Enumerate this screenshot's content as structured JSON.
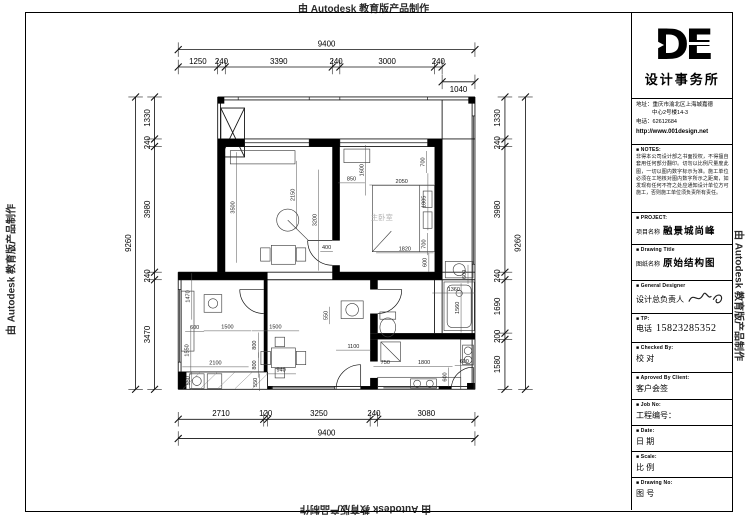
{
  "watermark": {
    "text": "由 Autodesk 教育版产品制作"
  },
  "title_block": {
    "logo_text": "DE",
    "company_name": "设计事务所",
    "address_label": "地址：",
    "address_line1": "重庆市渝北区上海城嘉德",
    "address_line2": "中心2号楼14-3",
    "phone_label": "电话：",
    "phone_number": "62612684",
    "website": "http://www.001design.net",
    "notes_label": "■ NOTES:",
    "notes_text": "非得本公司设计部之书面授权，不得擅自套用任何部分翻印。切勿以比例尺量度此图，一切以图内数字标示为准。施工单位必须在工地核对图内数字所示之距离，如发现有任何不符之处应通知设计单位方可施工，否则施工单位须负责所有责任。",
    "project_label": "■ PROJECT:",
    "project_name_label": "项目名称",
    "project_name": "融景城尚峰",
    "drawing_title_label": "■ Drawing Title",
    "drawing_name_label": "图纸名称",
    "drawing_name": "原始结构图",
    "designer_label": "■ General Designer",
    "designer_name_label": "设计总负责人",
    "tp_label": "■ TP:",
    "tel_label": "电话",
    "tel_number": "15823285352",
    "checked_label": "■ Checked By:",
    "checked_value": "校 对",
    "approved_label": "■ Aproved By Client:",
    "approved_value": "客户会签",
    "job_label": "■ Job No:",
    "job_value": "工程编号：",
    "date_label": "■ Date:",
    "date_value": "日 期",
    "scale_label": "■ Scale:",
    "scale_value": "比 例",
    "drawing_no_label": "■ Drawing No:",
    "drawing_no_value": "图 号"
  },
  "plan": {
    "room_labels": [
      {
        "text": "主卧室",
        "x": 6450,
        "y": 3900
      }
    ],
    "dims": {
      "top_overall": 9400,
      "top_chain": [
        1250,
        240,
        3390,
        240,
        3000,
        240
      ],
      "top_extra": 1040,
      "left_overall": 9260,
      "left_chain": [
        1330,
        240,
        3980,
        240,
        3470
      ],
      "right_chain": [
        1330,
        240,
        3980,
        240,
        1690,
        200,
        1580
      ],
      "right_overall": 9260,
      "bottom_chain": [
        2710,
        120,
        3250,
        240,
        3080
      ],
      "bottom_overall": 9400,
      "interior": [
        {
          "t": "3500",
          "x": 1780,
          "y": 3500,
          "r": -90
        },
        {
          "t": "2150",
          "x": 3680,
          "y": 3100,
          "r": -90
        },
        {
          "t": "3200",
          "x": 4380,
          "y": 3900,
          "r": -90
        },
        {
          "t": "400",
          "x": 4700,
          "y": 4820,
          "r": 0
        },
        {
          "t": "850",
          "x": 5490,
          "y": 2650,
          "r": 0
        },
        {
          "t": "1600",
          "x": 5870,
          "y": 2320,
          "r": -90
        },
        {
          "t": "2050",
          "x": 7080,
          "y": 2720,
          "r": 0
        },
        {
          "t": "700",
          "x": 7800,
          "y": 2060,
          "r": -90
        },
        {
          "t": "1805",
          "x": 7840,
          "y": 3320,
          "r": -90
        },
        {
          "t": "1820",
          "x": 7180,
          "y": 4870,
          "r": 0
        },
        {
          "t": "700",
          "x": 7830,
          "y": 4660,
          "r": -90
        },
        {
          "t": "600",
          "x": 7870,
          "y": 5240,
          "r": -90
        },
        {
          "t": "600",
          "x": 9110,
          "y": 5620,
          "r": -90
        },
        {
          "t": "1360",
          "x": 8730,
          "y": 6140,
          "r": 0
        },
        {
          "t": "1560",
          "x": 8890,
          "y": 6680,
          "r": -90
        },
        {
          "t": "1100",
          "x": 5550,
          "y": 7950,
          "r": 0
        },
        {
          "t": "750",
          "x": 6560,
          "y": 8460,
          "r": 0
        },
        {
          "t": "1800",
          "x": 7790,
          "y": 8460,
          "r": 0
        },
        {
          "t": "600",
          "x": 9060,
          "y": 8430,
          "r": 0
        },
        {
          "t": "600",
          "x": 8500,
          "y": 8870,
          "r": -90
        },
        {
          "t": "1470",
          "x": 360,
          "y": 6320,
          "r": -90
        },
        {
          "t": "600",
          "x": 520,
          "y": 7350,
          "r": 0
        },
        {
          "t": "1500",
          "x": 1560,
          "y": 7340,
          "r": 0
        },
        {
          "t": "1500",
          "x": 3080,
          "y": 7340,
          "r": 0
        },
        {
          "t": "1550",
          "x": 330,
          "y": 8030,
          "r": -90
        },
        {
          "t": "2100",
          "x": 1180,
          "y": 8480,
          "r": 0
        },
        {
          "t": "550",
          "x": 360,
          "y": 8990,
          "r": -90
        },
        {
          "t": "800",
          "x": 2470,
          "y": 7860,
          "r": -90
        },
        {
          "t": "800",
          "x": 2470,
          "y": 8490,
          "r": -90
        },
        {
          "t": "940",
          "x": 3260,
          "y": 8700,
          "r": 0
        },
        {
          "t": "550",
          "x": 2500,
          "y": 9040,
          "r": -90
        },
        {
          "t": "550",
          "x": 4730,
          "y": 6920,
          "r": -90
        }
      ]
    }
  }
}
